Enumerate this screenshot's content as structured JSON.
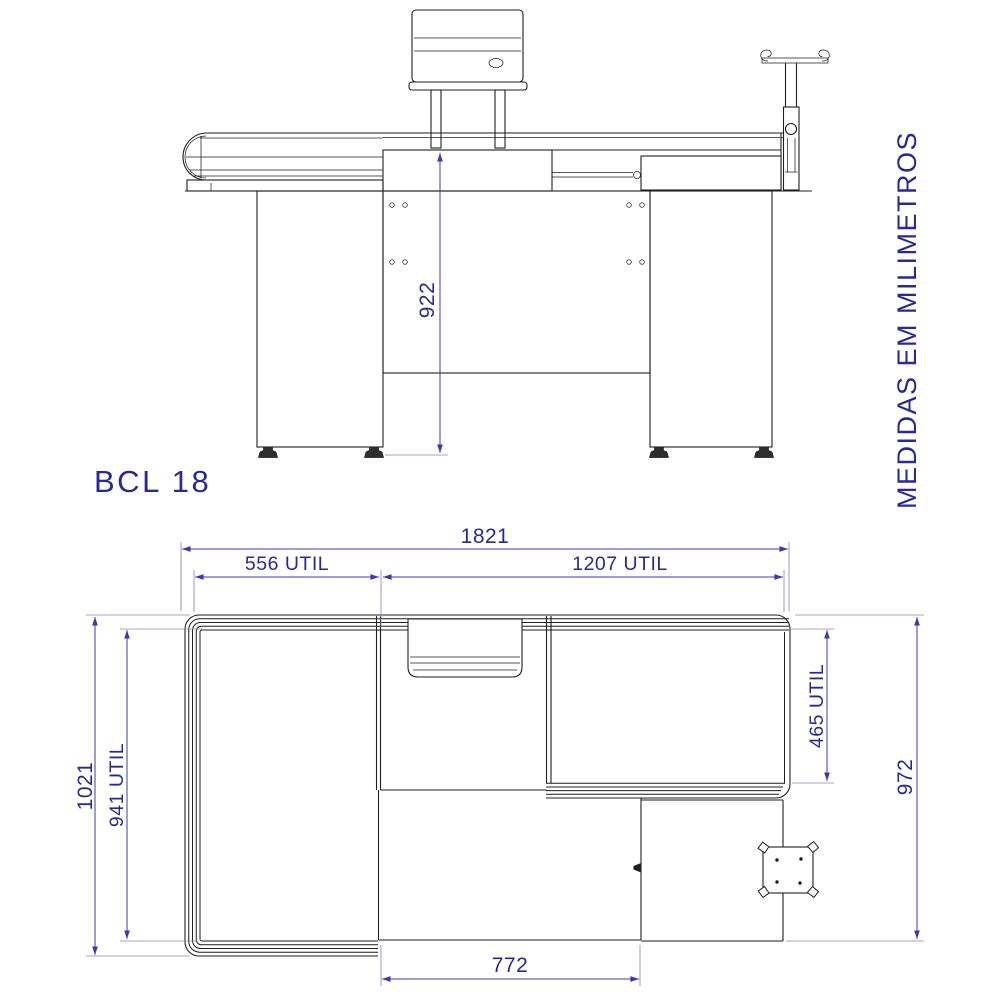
{
  "title": "BCL 18",
  "side_note": "MEDIDAS EM MILIMETROS",
  "views": {
    "front": {
      "dims": {
        "height": "922"
      }
    },
    "plan": {
      "dims": {
        "total_length": "1821",
        "left_useful_length": "556 UTIL",
        "right_useful_length": "1207 UTIL",
        "total_depth": "1021",
        "left_useful_depth": "941 UTIL",
        "right_useful_depth": "465 UTIL",
        "right_total_depth": "972",
        "lower_recess_width": "772"
      }
    }
  },
  "colors": {
    "dimension_text": "#28289b",
    "dimension_line": "#3a3aae",
    "extension_line": "#8888bb",
    "drawing_line": "#1f1f1f",
    "background": "#ffffff"
  }
}
